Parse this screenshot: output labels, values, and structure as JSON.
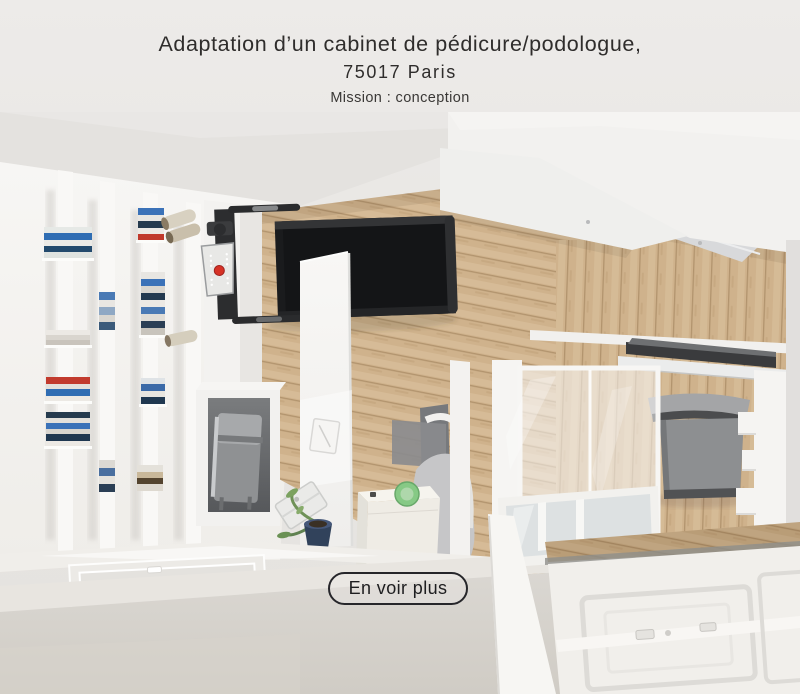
{
  "header": {
    "title_line1": "Adaptation d’un cabinet de pédicure/podologue,",
    "title_line2": "75017 Paris",
    "subtitle": "Mission : conception"
  },
  "cta": {
    "label": "En voir plus"
  },
  "scene": {
    "description": "Top-down cutaway 3D rendering of a pedicure/podology office: white fin bookshelf wall, wall-mounted folding treadmill, oak floor, consultation desk with laptop and plant, sterilizer unit, frosted glass partition with grey waiting chair, white panel doors",
    "colors": {
      "text": "#2f2d2c",
      "accent_red": "#d63226",
      "accent_green": "#86c985",
      "plant_pot": "#31425b",
      "wood": "#cfb28c",
      "wood_light": "#dcc3a0",
      "wood_seam": "#b2946e",
      "treadmill": "#1a1b1d",
      "chair_gray": "#8d8f91",
      "console": "#e8e8e6",
      "glass_white": "#f7f6f4",
      "cut_wall": "#d8d5d0",
      "button_border": "#26262a"
    }
  }
}
